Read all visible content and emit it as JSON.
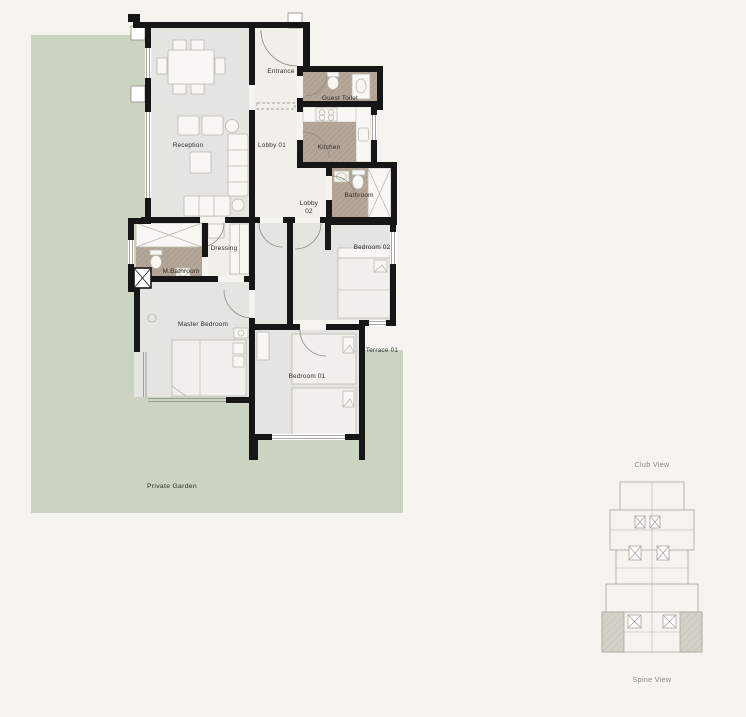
{
  "plan": {
    "rooms": {
      "entrance": "Entrance",
      "guest_toilet": "Guest Toilet",
      "reception": "Reception",
      "lobby_01": "Lobby 01",
      "kitchen": "Kitchen",
      "lobby_02_line1": "Lobby",
      "lobby_02_line2": "02",
      "bathroom": "Bathroom",
      "dressing": "Dressing",
      "m_bathroom": "M.Bathroom",
      "bedroom_02": "Bedroom 02",
      "master_bedroom": "Master Bedroom",
      "bedroom_01": "Bedroom 01",
      "terrace": "Terrace 01",
      "private_garden": "Private Garden"
    },
    "colors": {
      "background": "#f6f4ef",
      "garden": "#cbd3c3",
      "floor_gray": "#e4e4e0",
      "floor_light": "#f1efe9",
      "wet_floor": "#b4a799",
      "wall": "#161616"
    }
  },
  "key_plan": {
    "top_label": "Club View",
    "bottom_label": "Spine View",
    "highlight_color": "#d3d0c8"
  }
}
